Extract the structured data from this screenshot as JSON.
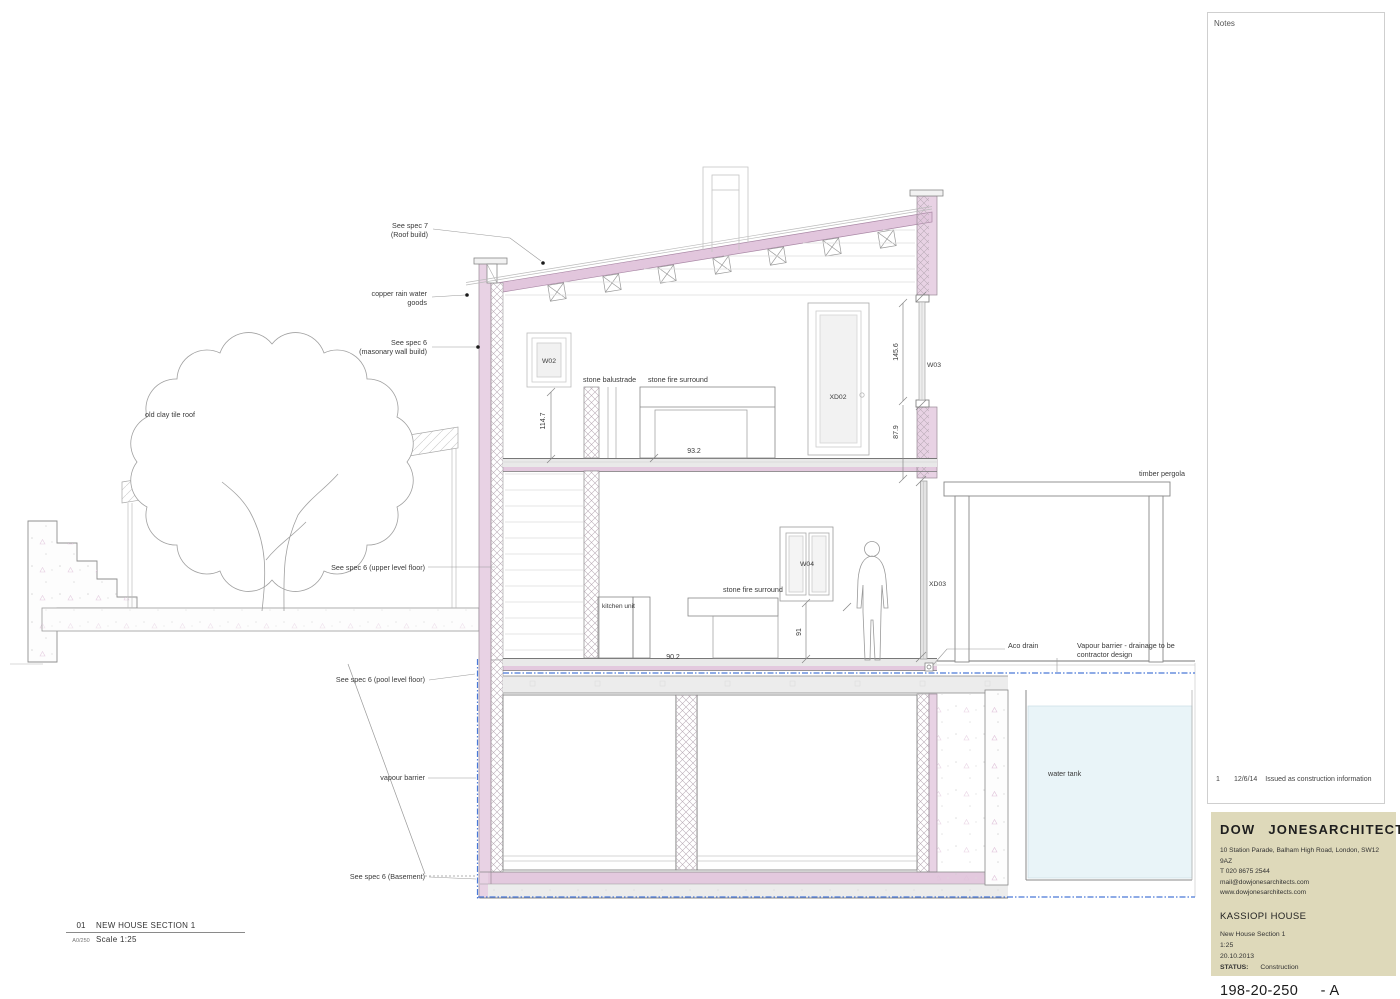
{
  "colors": {
    "wall_pink": "#e8d2e4",
    "roof_pink": "#e2c6dd",
    "slab_pink": "#e3c9de",
    "vapour_blue": "#4a79d8",
    "water_tank_fill": "#e9f4f8",
    "titleblock_bg": "#ded9ba"
  },
  "callouts": {
    "roof_spec_1": "See spec 7",
    "roof_spec_2": "(Roof build)",
    "copper_1": "copper rain water",
    "copper_2": "goods",
    "wall_spec_1": "See spec 6",
    "wall_spec_2": "(masonary wall build)",
    "old_roof": "old clay tile roof",
    "upper_floor": "See spec 6 (upper level floor)",
    "pool_floor": "See spec 6 (pool level floor)",
    "vapour": "vapour barrier",
    "basement": "See spec 6 (Basement)",
    "pergola": "timber pergola",
    "aco": "Aco drain",
    "vapour_drain_1": "Vapour barrier - drainage to be",
    "vapour_drain_2": "contractor design",
    "water_tank": "water tank",
    "balustrade": "stone balustrade",
    "fire_upper": "stone fire surround",
    "fire_lower": "stone fire surround",
    "kitchen": "kitchen unit"
  },
  "tags": {
    "w02": "W02",
    "w03": "W03",
    "w04": "W04",
    "xd02": "XD02",
    "xd03": "XD03"
  },
  "dims": {
    "wall_upper": "114.7",
    "window_w03": "145.6",
    "wall_mid": "87.9",
    "fire_opening": "93.2",
    "kitchen_h": "91",
    "worktop": "90.2"
  },
  "titlebar": {
    "number": "01",
    "sheet": "A0/250",
    "title": "NEW HOUSE SECTION 1",
    "scale": "Scale 1:25"
  },
  "notes": {
    "heading": "Notes",
    "rev_number": "1",
    "rev_date": "12/6/14",
    "rev_text": "Issued as construction information"
  },
  "titleblock": {
    "firm_word1": "DOW",
    "firm_word2": "JONES",
    "firm_word3": "ARCHITECTS",
    "address": "10 Station Parade, Balham High Road, London, SW12 9AZ",
    "phone": "T 020 8675 2544",
    "email": "mail@dowjonesarchitects.com",
    "website": "www.dowjonesarchitects.com",
    "project": "KASSIOPI HOUSE",
    "drawing_title": "New House Section 1",
    "scale": "1:25",
    "date": "20.10.2013",
    "status_label": "STATUS:",
    "status_value": "Construction",
    "number": "198-20-250",
    "revision": "- A"
  }
}
